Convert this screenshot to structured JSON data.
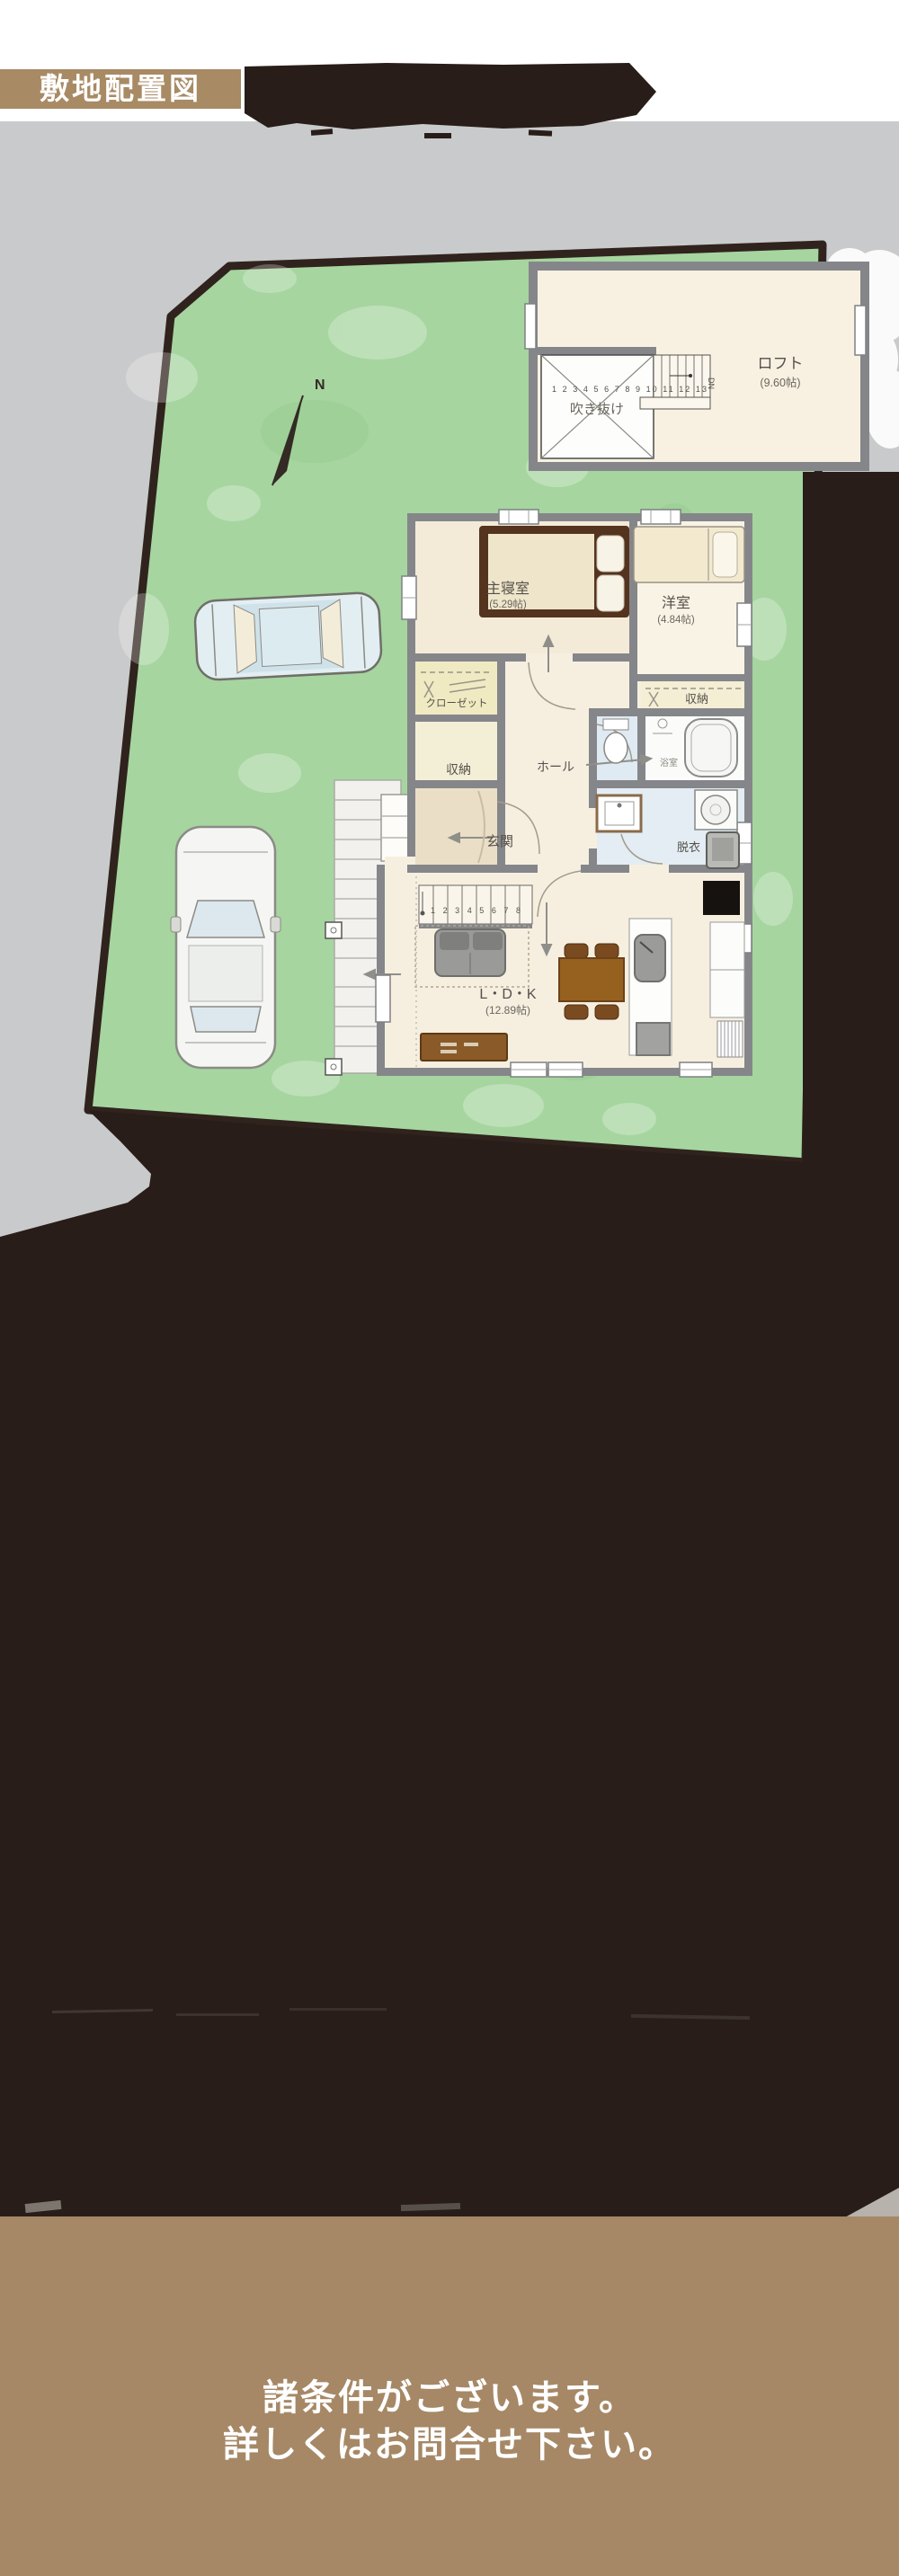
{
  "header": {
    "badge": "敷地配置図"
  },
  "compass": {
    "north": "N"
  },
  "loft": {
    "label": "ロフト",
    "size": "(9.60帖)",
    "void_label": "吹き抜け",
    "stair_numbers": "1 2 3 4 5 6 7 8 9 10 11 12 13",
    "down": "DN"
  },
  "floor": {
    "master_bedroom": "主寝室",
    "master_bedroom_size": "(5.29帖)",
    "western_room": "洋室",
    "western_room_size": "(4.84帖)",
    "closet": "クローゼット",
    "storage": "収納",
    "storage2": "収納",
    "hall": "ホール",
    "entrance": "玄関",
    "bath": "浴室",
    "dressing": "脱衣",
    "ldk": "L・D・K",
    "ldk_size": "(12.89帖)",
    "stair_numbers": "1 2 3 4 5 6 7 8"
  },
  "footer": {
    "line1": "諸条件がございます。",
    "line2": "詳しくはお問合せ下さい。"
  },
  "colors": {
    "badge_brown": "#a88a64",
    "footer_brown": "#a68866",
    "ink_dark": "#281d18",
    "bg_gray": "#c9cacb",
    "plot_green": "#a6d5a0",
    "wall_gray": "#85868a",
    "floor_cream": "#f6efe0",
    "notice_text": "#ffffff"
  }
}
